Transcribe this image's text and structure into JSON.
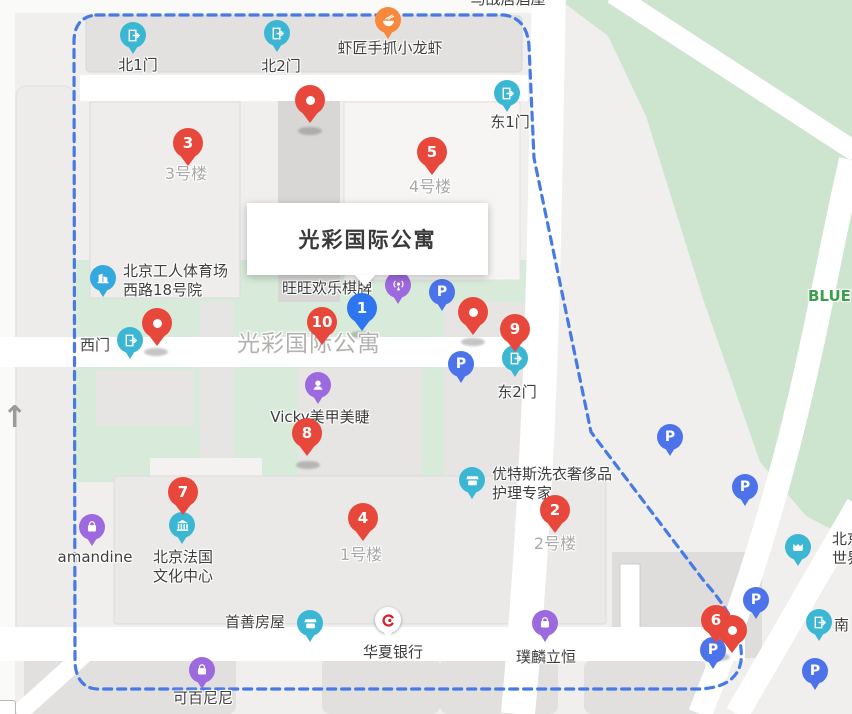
{
  "info_window": {
    "text": "光彩国际公寓"
  },
  "north_arrow_glyph": "↑",
  "colors": {
    "marker_red": "#e8483b",
    "marker_blue": "#2e75f0",
    "boundary_blue": "#477be4",
    "gate_teal": "#3bb7d3",
    "poi_purple": "#9c6ade",
    "parking_blue": "#4c73e9",
    "food_orange": "#f8883b",
    "building_blue": "#35a9dd",
    "bank_red": "#d2232f",
    "park_green": "#cde5cf",
    "lawn_green": "#d8ebda"
  },
  "markers": [
    {
      "n": "1",
      "type": "blue",
      "x": 362,
      "y": 308
    },
    {
      "n": "2",
      "type": "red",
      "x": 555,
      "y": 510
    },
    {
      "n": "3",
      "type": "red",
      "x": 188,
      "y": 143
    },
    {
      "n": "4",
      "type": "red",
      "x": 363,
      "y": 518
    },
    {
      "n": "5",
      "type": "red",
      "x": 432,
      "y": 152
    },
    {
      "n": "6",
      "type": "red",
      "x": 716,
      "y": 620
    },
    {
      "n": "7",
      "type": "red",
      "x": 183,
      "y": 492
    },
    {
      "n": "8",
      "type": "red",
      "x": 307,
      "y": 433
    },
    {
      "n": "9",
      "type": "red",
      "x": 515,
      "y": 329
    },
    {
      "n": "10",
      "type": "red",
      "x": 322,
      "y": 322
    }
  ],
  "plain_red_pins": [
    {
      "x": 310,
      "y": 100
    },
    {
      "x": 157,
      "y": 323
    },
    {
      "x": 473,
      "y": 312
    },
    {
      "x": 732,
      "y": 630
    }
  ],
  "pin_shadows": [
    {
      "x": 310,
      "y": 131
    },
    {
      "x": 156,
      "y": 352
    },
    {
      "x": 362,
      "y": 335
    },
    {
      "x": 473,
      "y": 342
    },
    {
      "x": 308,
      "y": 465
    },
    {
      "x": 718,
      "y": 657
    }
  ],
  "pois": [
    {
      "name": "gate-north-1",
      "icon": "gate",
      "color": "gate_teal",
      "x": 133,
      "y": 35
    },
    {
      "name": "gate-north-2",
      "icon": "gate",
      "color": "gate_teal",
      "x": 277,
      "y": 33
    },
    {
      "name": "gate-east-1",
      "icon": "gate",
      "color": "gate_teal",
      "x": 507,
      "y": 93
    },
    {
      "name": "gate-west",
      "icon": "gate",
      "color": "gate_teal",
      "x": 130,
      "y": 340
    },
    {
      "name": "gate-east-2",
      "icon": "gate",
      "color": "gate_teal",
      "x": 515,
      "y": 358
    },
    {
      "name": "gate-south",
      "icon": "gate",
      "color": "gate_teal",
      "x": 819,
      "y": 622
    },
    {
      "name": "restaurant-crayfish",
      "icon": "food",
      "color": "food_orange",
      "x": 388,
      "y": 20
    },
    {
      "name": "residence-gongti",
      "icon": "building",
      "color": "building_blue",
      "x": 103,
      "y": 278
    },
    {
      "name": "mahjong-wangwang",
      "icon": "broadcast",
      "color": "poi_purple",
      "x": 398,
      "y": 285
    },
    {
      "name": "nails-vicky",
      "icon": "face",
      "color": "poi_purple",
      "x": 318,
      "y": 385
    },
    {
      "name": "shop-amandine",
      "icon": "bag",
      "color": "poi_purple",
      "x": 92,
      "y": 527
    },
    {
      "name": "laundry-youtesi",
      "icon": "store",
      "color": "gate_teal",
      "x": 472,
      "y": 480
    },
    {
      "name": "france-culture-center",
      "icon": "museum",
      "color": "gate_teal",
      "x": 182,
      "y": 525
    },
    {
      "name": "realty-shoushan",
      "icon": "store",
      "color": "gate_teal",
      "x": 310,
      "y": 623
    },
    {
      "name": "bank-huaxia",
      "icon": "bank",
      "color": "bank_white",
      "x": 388,
      "y": 620
    },
    {
      "name": "shop-pulin",
      "icon": "bag",
      "color": "poi_purple",
      "x": 545,
      "y": 623
    },
    {
      "name": "shop-kebainini",
      "icon": "bag",
      "color": "poi_purple",
      "x": 202,
      "y": 670
    },
    {
      "name": "theater-beijing-world",
      "icon": "theater",
      "color": "gate_teal",
      "x": 798,
      "y": 547
    }
  ],
  "parking_pins": [
    {
      "x": 442,
      "y": 292
    },
    {
      "x": 461,
      "y": 364
    },
    {
      "x": 670,
      "y": 437
    },
    {
      "x": 745,
      "y": 487
    },
    {
      "x": 756,
      "y": 600
    },
    {
      "x": 713,
      "y": 650
    },
    {
      "x": 815,
      "y": 671
    }
  ],
  "parking_glyph": "P",
  "labels": [
    {
      "name": "north-gate-1",
      "text": "北1门",
      "x": 138,
      "y": 56,
      "cls": ""
    },
    {
      "name": "north-gate-2",
      "text": "北2门",
      "x": 281,
      "y": 57,
      "cls": ""
    },
    {
      "name": "crayfish-restaurant",
      "text": "虾匠手抓小龙虾",
      "x": 390,
      "y": 39,
      "cls": ""
    },
    {
      "name": "east-gate-1",
      "text": "东1门",
      "x": 510,
      "y": 113,
      "cls": ""
    },
    {
      "name": "west-gate",
      "text": "西门",
      "x": 95,
      "y": 336,
      "cls": ""
    },
    {
      "name": "east-gate-2",
      "text": "东2门",
      "x": 517,
      "y": 383,
      "cls": ""
    },
    {
      "name": "izakaya-top",
      "text": "马战居酒屋",
      "x": 508,
      "y": -10,
      "cls": ""
    },
    {
      "name": "building-3",
      "text": "3号楼",
      "x": 186,
      "y": 164,
      "cls": "bldg"
    },
    {
      "name": "building-4",
      "text": "4号楼",
      "x": 430,
      "y": 177,
      "cls": "bldg"
    },
    {
      "name": "building-1",
      "text": "1号楼",
      "x": 361,
      "y": 545,
      "cls": "bldg"
    },
    {
      "name": "building-2",
      "text": "2号楼",
      "x": 555,
      "y": 534,
      "cls": "bldg"
    },
    {
      "name": "complex-area-name",
      "text": "光彩国际公寓",
      "x": 309,
      "y": 335,
      "cls": "big"
    },
    {
      "name": "wangwang-mahjong",
      "text": "旺旺欢乐棋牌",
      "x": 327,
      "y": 279,
      "cls": ""
    },
    {
      "name": "vicky-nails",
      "text": "Vicky美甲美睫",
      "x": 320,
      "y": 408,
      "cls": ""
    },
    {
      "name": "gongti-residence",
      "lines": [
        "北京工人体育场",
        "西路18号院"
      ],
      "x": 123,
      "y": 262,
      "cls": "left"
    },
    {
      "name": "youtesi-laundry",
      "lines": [
        "优特斯洗衣奢侈品",
        "护理专家"
      ],
      "x": 492,
      "y": 465,
      "cls": "left"
    },
    {
      "name": "amandine",
      "text": "amandine",
      "x": 95,
      "y": 548,
      "cls": ""
    },
    {
      "name": "france-culture-center",
      "lines": [
        "北京法国",
        "文化中心"
      ],
      "x": 183,
      "y": 548,
      "cls": ""
    },
    {
      "name": "shoushan-realty",
      "text": "首善房屋",
      "x": 255,
      "y": 613,
      "cls": ""
    },
    {
      "name": "huaxia-bank",
      "text": "华夏银行",
      "x": 393,
      "y": 643,
      "cls": ""
    },
    {
      "name": "pulin-liheng",
      "text": "璞麟立恒",
      "x": 546,
      "y": 648,
      "cls": ""
    },
    {
      "name": "kebainini",
      "text": "可百尼尼",
      "x": 203,
      "y": 689,
      "cls": ""
    },
    {
      "name": "blue-building",
      "text": "BLUE",
      "x": 808,
      "y": 287,
      "cls": "green left"
    },
    {
      "name": "beijing-world",
      "lines": [
        "北京",
        "世界"
      ],
      "x": 832,
      "y": 530,
      "cls": "left"
    },
    {
      "name": "south-partial",
      "text": "南",
      "x": 834,
      "y": 616,
      "cls": "left"
    }
  ]
}
